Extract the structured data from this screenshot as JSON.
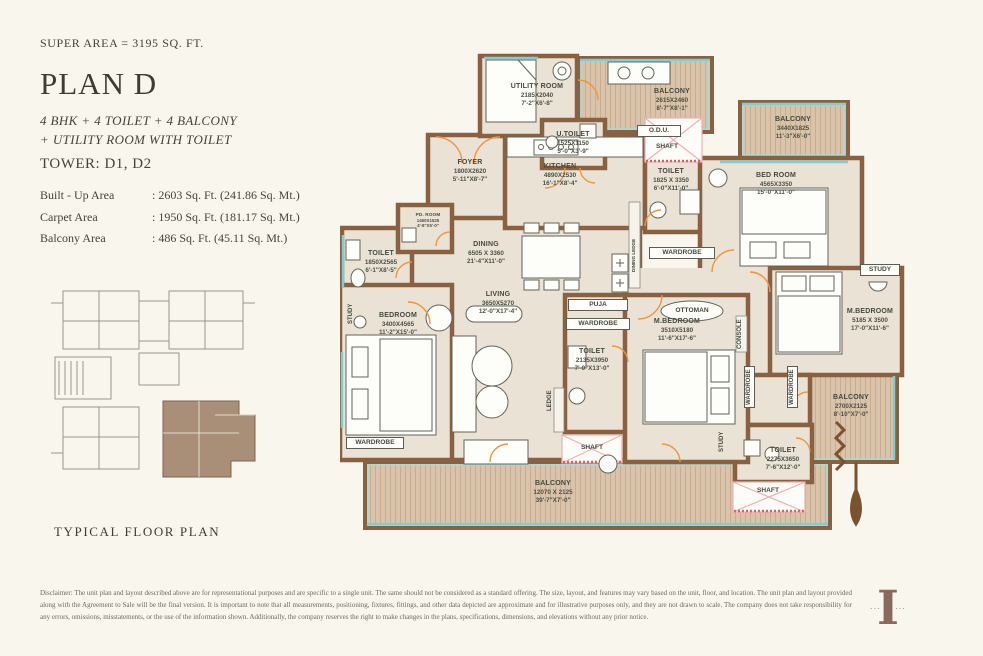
{
  "header": {
    "super_area": "SUPER AREA = 3195 SQ. FT.",
    "plan_title": "PLAN D",
    "config_line1": "4 BHK + 4 TOILET + 4 BALCONY",
    "config_line2": "+ UTILITY ROOM WITH TOILET",
    "tower": "TOWER: D1, D2",
    "areas": [
      {
        "label": "Built - Up Area",
        "value": ": 2603 Sq. Ft. (241.86 Sq. Mt.)"
      },
      {
        "label": "Carpet Area",
        "value": ": 1950 Sq. Ft. (181.17 Sq. Mt.)"
      },
      {
        "label": "Balcony Area",
        "value": ": 486 Sq. Ft. (45.11 Sq. Mt.)"
      }
    ],
    "key_plan_caption": "TYPICAL FLOOR PLAN"
  },
  "plan": {
    "rooms": [
      {
        "name": "UTILITY ROOM",
        "mm": "2185X2040",
        "ft": "7'-2\"X6'-8\""
      },
      {
        "name": "U.TOILET",
        "mm": "1525X1150",
        "ft": "5'-0\"X3'-9\""
      },
      {
        "name": "BALCONY",
        "mm": "2615X2460",
        "ft": "8'-7\"X8'-1\""
      },
      {
        "name": "BALCONY",
        "mm": "3440X1825",
        "ft": "11'-3\"X6'-0\""
      },
      {
        "name": "TOILET",
        "mm": "1825 X 3350",
        "ft": "6'-0\"X11'-0\""
      },
      {
        "name": "BED ROOM",
        "mm": "4565X3350",
        "ft": "15'-0\"X11'-0\""
      },
      {
        "name": "M.BEDROOM",
        "mm": "5185 X 3500",
        "ft": "17'-0\"X11'-6\""
      },
      {
        "name": "BALCONY",
        "mm": "2700X2125",
        "ft": "8'-10\"X7'-0\""
      },
      {
        "name": "TOILET",
        "mm": "2275X3650",
        "ft": "7'-6\"X12'-0\""
      },
      {
        "name": "FOYER",
        "mm": "1800X2620",
        "ft": "5'-11\"X8'-7\""
      },
      {
        "name": "KITCHEN",
        "mm": "4890X2530",
        "ft": "16'-1\"X8'-4\""
      },
      {
        "name": "DINING",
        "mm": "6505 X 3360",
        "ft": "21'-4\"X11'-0\""
      },
      {
        "name": "LIVING",
        "mm": "3650X5270",
        "ft": "12'-0\"X17'-4\""
      },
      {
        "name": "TOILET",
        "mm": "1850X2565",
        "ft": "6'-1\"X8'-5\""
      },
      {
        "name": "PD. ROOM",
        "mm": "1460X1525",
        "ft": "4'-8\"X5'-0\""
      },
      {
        "name": "BEDROOM",
        "mm": "3400X4565",
        "ft": "11'-2\"X15'-0\""
      },
      {
        "name": "TOILET",
        "mm": "2135X3950",
        "ft": "7'-0\"X13'-0\""
      },
      {
        "name": "M.BEDROOM",
        "mm": "3510X5180",
        "ft": "11'-6\"X17'-6\""
      },
      {
        "name": "BALCONY",
        "mm": "12070 X 2125",
        "ft": "39'-7\"X7'-0\""
      }
    ],
    "tags": [
      {
        "text": "O.D.U."
      },
      {
        "text": "SHAFT"
      },
      {
        "text": "WARDROBE"
      },
      {
        "text": "STUDY"
      },
      {
        "text": "SHAFT"
      },
      {
        "text": "STUDY"
      },
      {
        "text": "WARDROBE"
      },
      {
        "text": "PUJA"
      },
      {
        "text": "WARDROBE"
      },
      {
        "text": "LEDGE"
      },
      {
        "text": "OTTOMAN"
      },
      {
        "text": "CONSOLE"
      },
      {
        "text": "WARDROBE"
      },
      {
        "text": "WARDROBE"
      },
      {
        "text": "STUDY"
      },
      {
        "text": "SHAFT"
      },
      {
        "text": "DINING LEDGE"
      }
    ]
  },
  "footer": {
    "disclaimer": "Disclaimer: The unit plan and layout described above are for representational purposes and are specific to a single unit. The same should not be considered as a standard offering. The size, layout, and features may vary based on the unit, floor, and location. The unit plan and layout provided along with the Agreement to Sale will be the final version. It is important to note that all measurements, positioning, fixtures, fittings, and other data depicted are approximate and for illustrative purposes only, and they are not drawn to scale. The company does not take responsibility for any errors, omissions, misstatements, or the use of the information shown. Additionally, the company reserves the right to make changes in the plans, specifications, dimensions, and elevations without any prior notice.",
    "logo_letter": "I",
    "logo_flourish": "··· ✦ ···"
  },
  "colors": {
    "background": "#f9f6ee",
    "wall_brown": "#8a6140",
    "room_fill": "#eae2d4",
    "balcony_wood": "#d9c3ab",
    "window_cyan": "#7ccfd4",
    "door_orange": "#f09540",
    "shaft_pink": "#efb0b0",
    "key_highlight": "#a98f77"
  }
}
